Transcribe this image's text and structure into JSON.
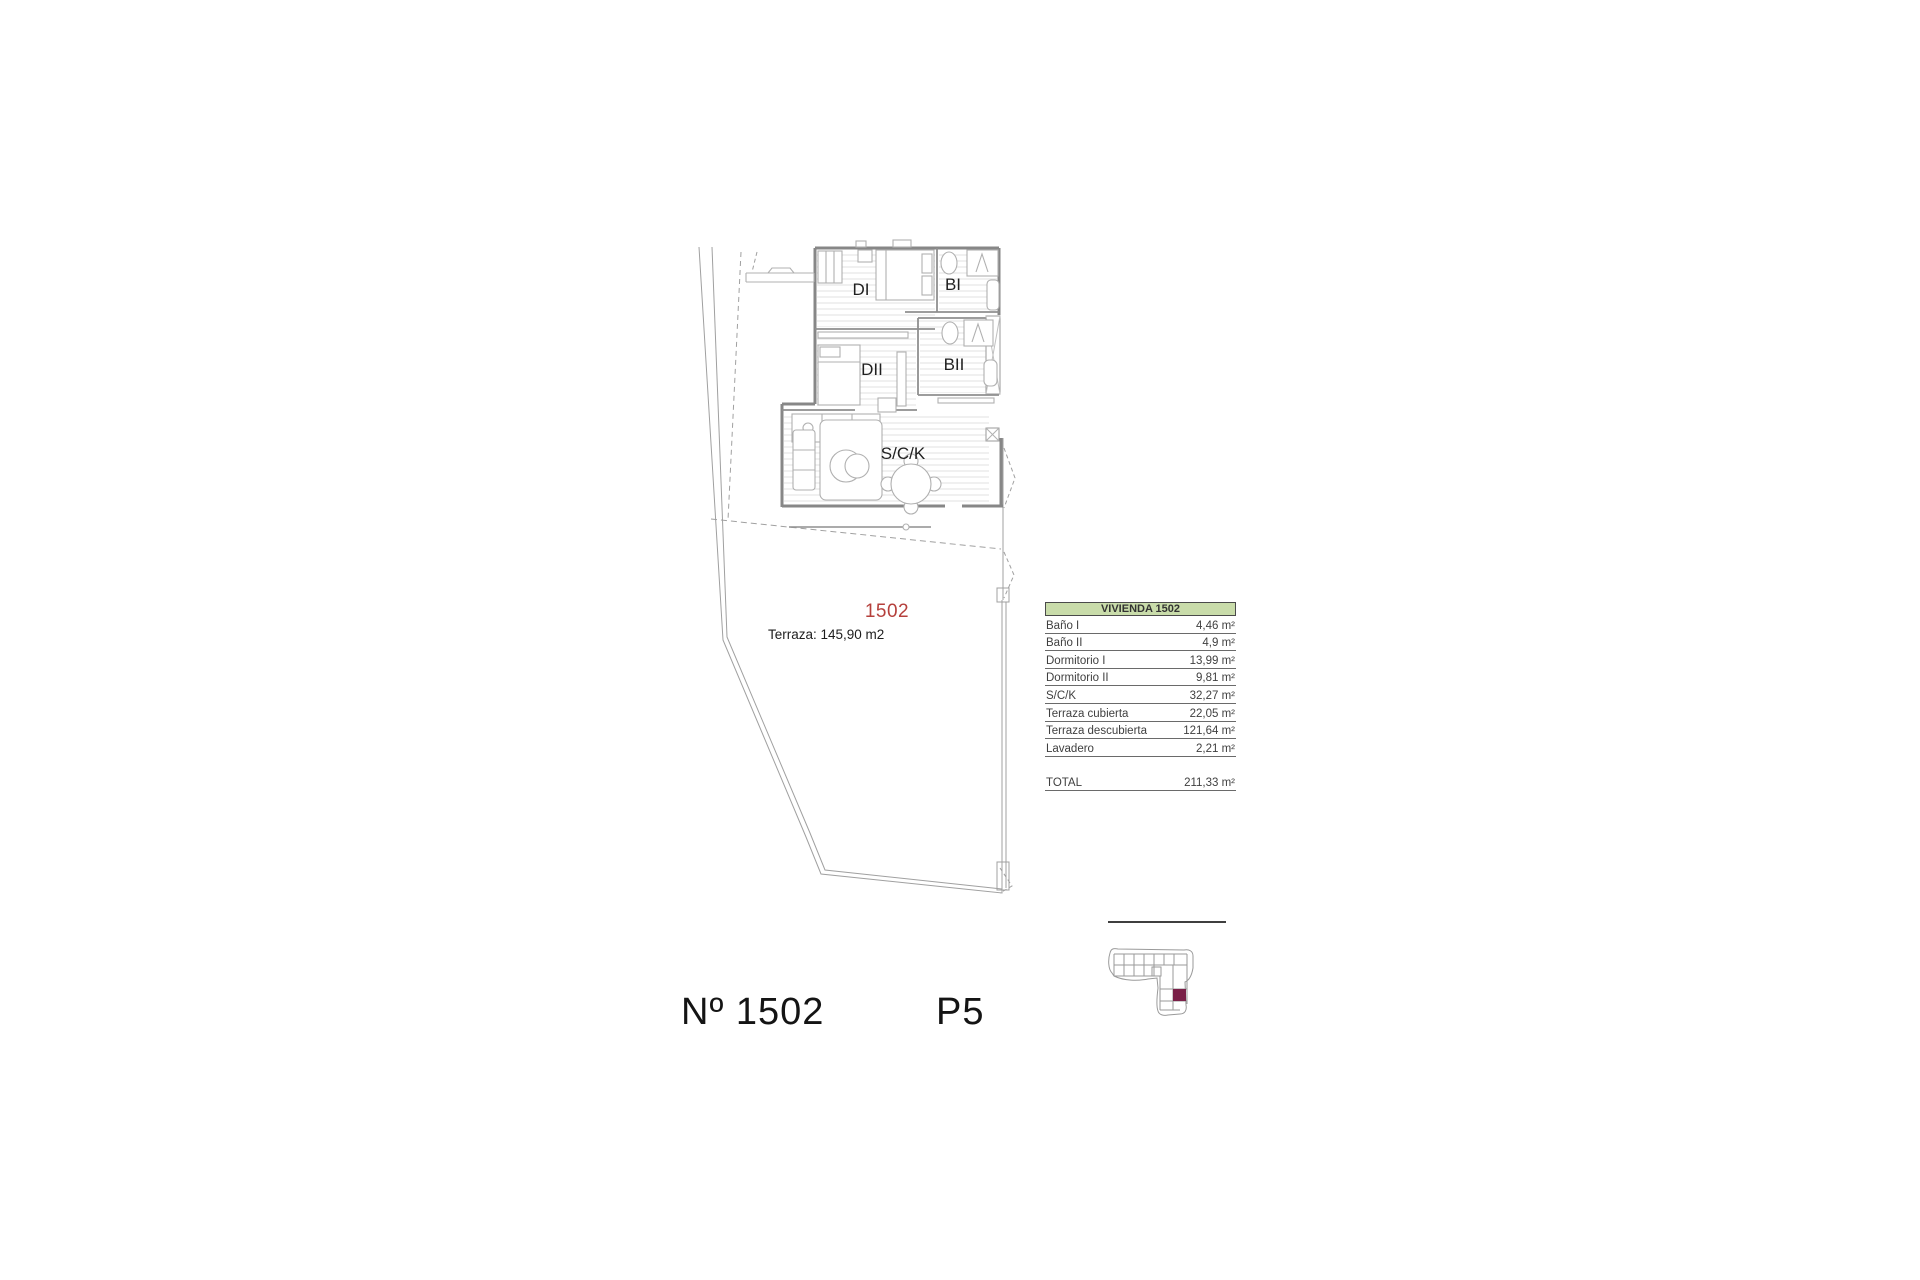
{
  "plan": {
    "unit_label_red": "1502",
    "terrace_note": "Terraza: 145,90 m2",
    "rooms": {
      "di": "DI",
      "bi": "BI",
      "dii": "DII",
      "bii": "BII",
      "sck": "S/C/K"
    }
  },
  "area_table": {
    "title": "VIVIENDA 1502",
    "rows": [
      {
        "label": "Baño I",
        "value": "4,46 m²"
      },
      {
        "label": "Baño II",
        "value": "4,9 m²"
      },
      {
        "label": "Dormitorio I",
        "value": "13,99 m²"
      },
      {
        "label": "Dormitorio II",
        "value": "9,81 m²"
      },
      {
        "label": "S/C/K",
        "value": "32,27 m²"
      },
      {
        "label": "Terraza cubierta",
        "value": "22,05 m²"
      },
      {
        "label": "Terraza descubierta",
        "value": "121,64 m²"
      },
      {
        "label": "Lavadero",
        "value": "2,21 m²"
      }
    ],
    "total_label": "TOTAL",
    "total_value": "211,33 m²"
  },
  "footer": {
    "unit_no": "Nº 1502",
    "floor": "P5"
  },
  "colors": {
    "accent_red": "#b5403c",
    "table_header_bg": "#c9dcaa",
    "keyplan_highlight": "#7a2048",
    "wall_gray": "#878787",
    "line_gray": "#a0a0a0"
  }
}
